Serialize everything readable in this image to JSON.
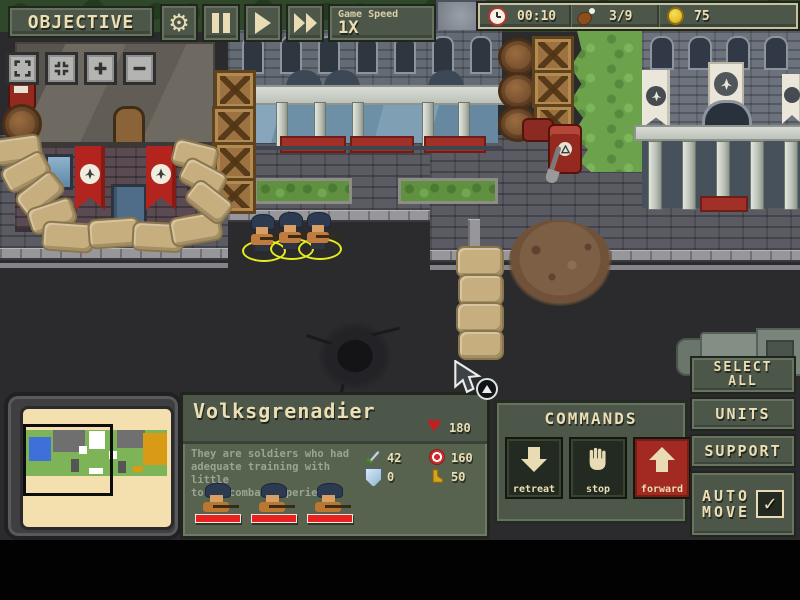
{
  "hud": {
    "objective": "OBJECTIVE",
    "game_speed_label": "Game Speed",
    "game_speed_value": "1X",
    "time": "00:10",
    "food": "3/9",
    "gold": "75"
  },
  "unit_panel": {
    "name": "Volksgrenadier",
    "hp": "180",
    "desc1": "They are soldiers who had",
    "desc2": "adequate training with little",
    "desc3": "to no combat experience",
    "attack": "42",
    "ammo": "160",
    "armor": "0",
    "speed": "50"
  },
  "commands": {
    "title": "COMMANDS",
    "retreat": "retreat",
    "stop": "stop",
    "forward": "forward"
  },
  "right_panel": {
    "select1": "SELECT",
    "select2": "ALL",
    "units": "UNITS",
    "support": "SUPPORT",
    "auto1": "AUTO",
    "auto2": "MOVE",
    "check_mark": "✓"
  },
  "icons": {
    "settings": "gear",
    "pause": "pause-bars",
    "play": "play-triangle",
    "fast_forward": "double-play-triangle",
    "time": "clock",
    "food": "meat-drumstick",
    "gold": "coin",
    "hp": "heart",
    "attack": "sword",
    "ammo": "target",
    "armor": "shield",
    "speed": "boot",
    "retreat": "arrow-down",
    "stop": "hand",
    "forward": "arrow-up",
    "auto_move": "checkbox-checked",
    "zoom_controls": [
      "expand-view",
      "fit-view",
      "zoom-in",
      "zoom-out"
    ]
  },
  "colors": {
    "panel_olive": "#4c574a",
    "text_cream": "#ecdfb4",
    "forward_red": "#a32a22",
    "hp_red": "#ea1f1f",
    "coin_gold": "#e8c531",
    "selection_yellow": "#e6ef1a",
    "banner_red": "#b3241e",
    "minimap_paper": "#f4dfae",
    "road_dark": "#2b2b2d"
  }
}
